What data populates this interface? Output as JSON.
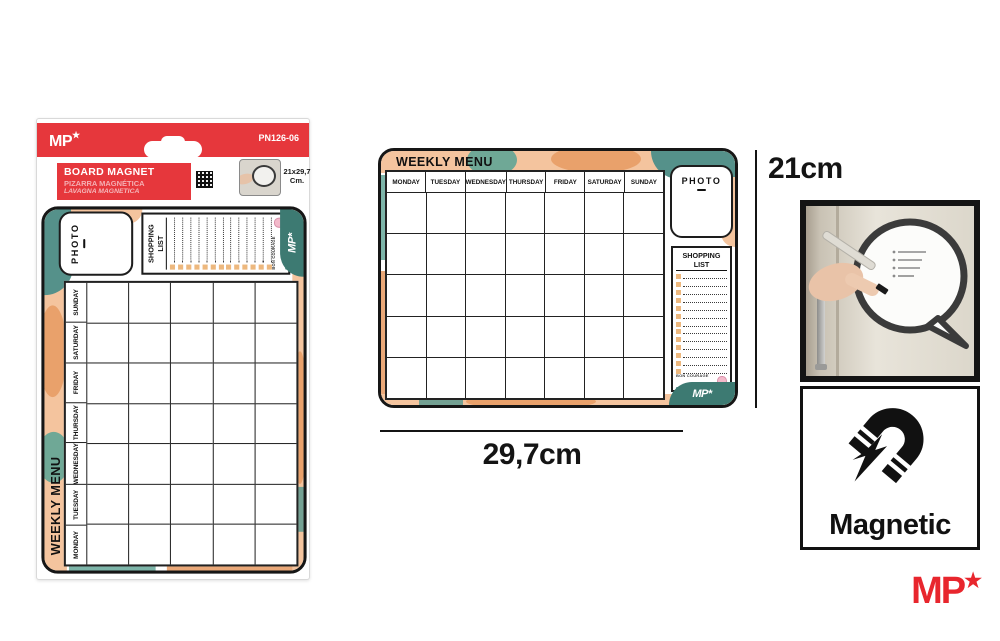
{
  "package": {
    "brand": {
      "text": "MP",
      "star": "★"
    },
    "code": "PN126-06",
    "label": {
      "line1": "BOARD MAGNET",
      "line2": "PIZARRA MAGNÉTICA",
      "line3": "LAVAGNA MAGNETICA"
    },
    "size_text_line1": "21x29,7",
    "size_text_line2": "Cm."
  },
  "board": {
    "title": "WEEKLY MENU",
    "days": [
      "MONDAY",
      "TUESDAY",
      "WEDNESDAY",
      "THURSDAY",
      "FRIDAY",
      "SATURDAY",
      "SUNDAY"
    ],
    "rows": 5,
    "photo_label": "PHOTO",
    "shopping": {
      "title": "SHOPPING LIST",
      "rows": 13,
      "footer_line1": "BON COURAGE",
      "footer_line2": "BON APPETIT"
    },
    "brand": "MP*"
  },
  "dimensions": {
    "height_label": "21cm",
    "width_label": "29,7cm"
  },
  "magnetic": {
    "label": "Magnetic"
  },
  "footer_brand": {
    "text": "MP",
    "star": "★"
  },
  "colors": {
    "brand_red": "#e6373c",
    "logo_red": "#e8262d",
    "board_teal": "#55918a",
    "corner_teal": "#3d7a72",
    "board_peach": "#f4c49e",
    "leaf_orange": "#e9a16b",
    "checkbox_orange": "#edb87e",
    "footer_pink": "#f3b9ca"
  }
}
